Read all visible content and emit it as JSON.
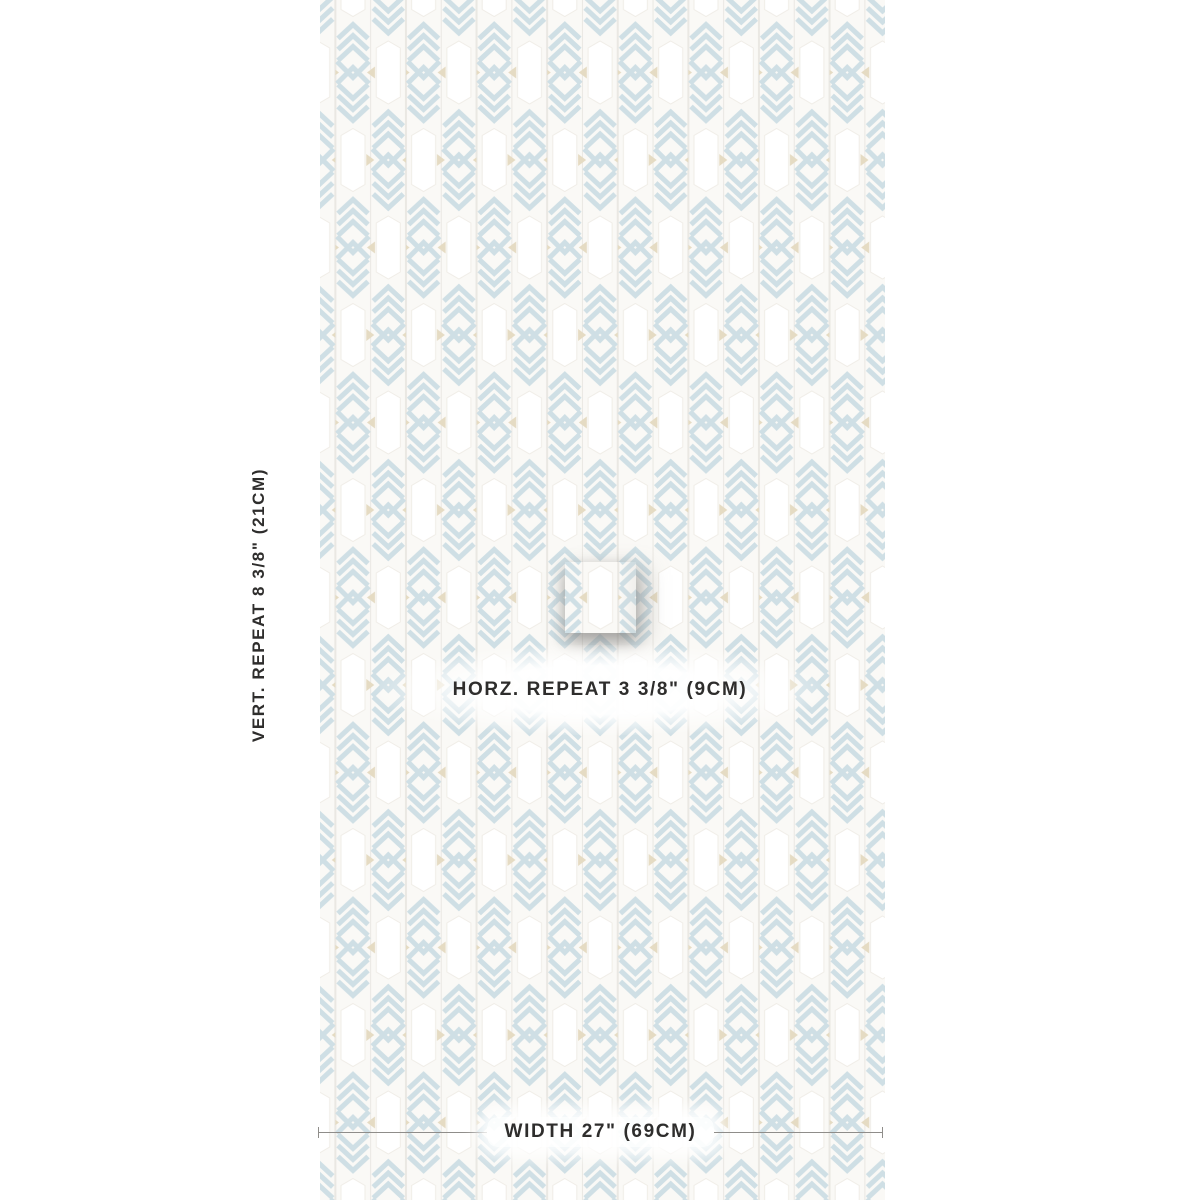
{
  "page": {
    "title": "Wallpaper swatch measurement diagram"
  },
  "pattern": {
    "motif": "chevron-arrow-feather",
    "colors": {
      "stripe_blue": "#cfdfe5",
      "accent_beige": "#e5dbc3",
      "background": "#faf9f6",
      "plank": "#ffffff"
    }
  },
  "labels": {
    "vert": {
      "prefix": "VERT. REPEAT ",
      "value": "8 3/8\" (21CM)"
    },
    "horz": {
      "prefix": "HORZ. REPEAT  ",
      "value": "3 3/8\" (9CM)"
    },
    "width": {
      "prefix": "WIDTH ",
      "value": "27\" (69CM)"
    }
  }
}
